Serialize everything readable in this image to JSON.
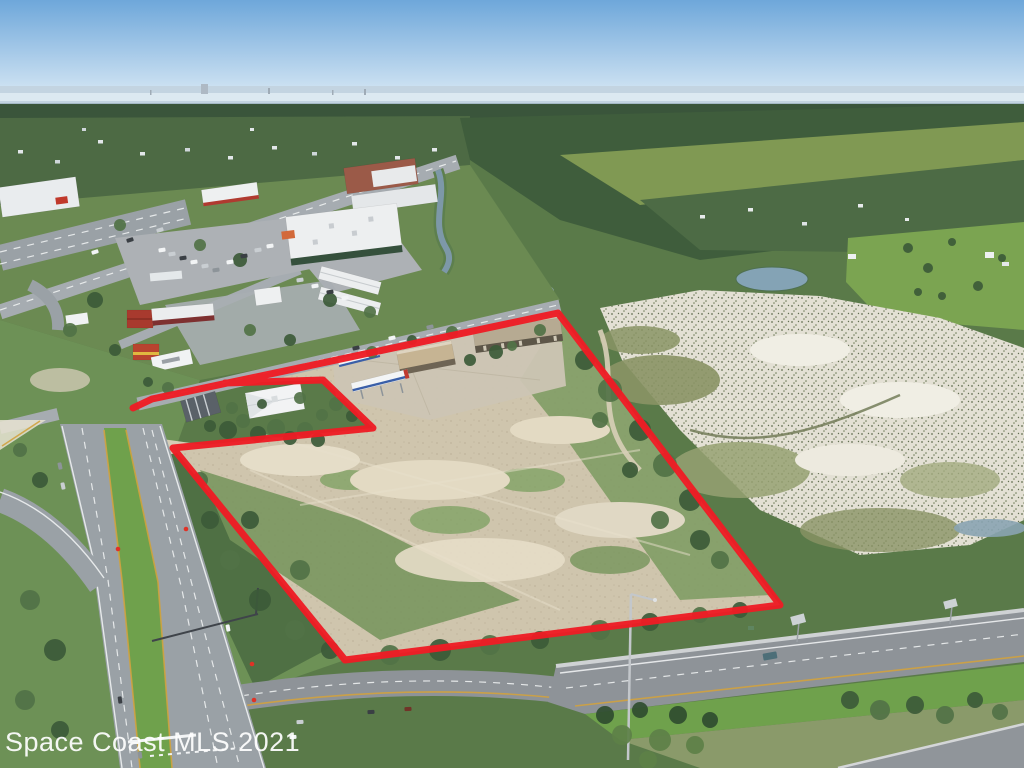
{
  "watermark": {
    "text": "Space Coast MLS 2021",
    "color": "#ffffff"
  },
  "boundary": {
    "color": "#ee1c24",
    "stroke_width": 7,
    "points": "133,408 152,399 558,313 780,605 345,660 173,448 373,428 323,380 225,383"
  },
  "palette": {
    "sky_top": "#6ea7da",
    "sky_horizon": "#d9e9f5",
    "water": "#c3d4e1",
    "water_streak": "#e2edf5",
    "far_shore": "#8ba3b0",
    "far_forest": "#3a553b",
    "suburb_green": "#4d6a44",
    "forest_right": "#3f5d3c",
    "marsh_grass_band": "#87a055",
    "mid_green_right": "#4d6b45",
    "golf_green": "#7ba451",
    "pond_blue": "#84a3b5",
    "land_base": "#5a7a49",
    "lawn_green": "#6b8a52",
    "bottomleft_grass": "#6d9156",
    "marsh_sand": "#e3e0d4",
    "marsh_olive": "#8a9465",
    "property_dirt": "#cfc5ad",
    "sand_light": "#e5ddc8",
    "concrete_pad": "#ccc5b4",
    "scrub_green": "#7b9a60",
    "shrub_dark": "#4f7044",
    "road_grey": "#a6acb1",
    "highway_grey": "#8e9398",
    "corridor_grey": "#9aa1a6",
    "parking_grey": "#adb1b5",
    "median_green": "#6fa14c",
    "signal_red": "#e03226"
  },
  "scene": {
    "houses": [
      [
        18,
        150,
        5,
        3.5,
        "#e3e7ea"
      ],
      [
        55,
        160,
        5,
        3.5,
        "#cfd6da"
      ],
      [
        98,
        140,
        5,
        3.5,
        "#e3e7ea"
      ],
      [
        140,
        152,
        5,
        3.5,
        "#e3e7ea"
      ],
      [
        185,
        148,
        5,
        3.5,
        "#cfd6da"
      ],
      [
        228,
        156,
        5,
        3.5,
        "#e3e7ea"
      ],
      [
        272,
        146,
        5,
        3.5,
        "#e3e7ea"
      ],
      [
        312,
        152,
        5,
        3.5,
        "#cfd6da"
      ],
      [
        352,
        142,
        5,
        3.5,
        "#e3e7ea"
      ],
      [
        395,
        156,
        5,
        3.5,
        "#e3e7ea"
      ],
      [
        82,
        128,
        4,
        3,
        "#cfd6da"
      ],
      [
        250,
        128,
        4,
        3,
        "#e3e7ea"
      ],
      [
        432,
        148,
        5,
        3.5,
        "#e3e7ea"
      ],
      [
        700,
        215,
        5,
        3.5,
        "#e8ebec"
      ],
      [
        748,
        208,
        5,
        3.5,
        "#e8ebec"
      ],
      [
        802,
        222,
        5,
        3.5,
        "#dfe3e6"
      ],
      [
        858,
        204,
        5,
        3.5,
        "#e8ebec"
      ],
      [
        905,
        218,
        4,
        3,
        "#e8ebec"
      ],
      [
        848,
        254,
        8,
        5,
        "#eef0f1"
      ],
      [
        985,
        252,
        9,
        6,
        "#eef0f1"
      ],
      [
        1002,
        262,
        7,
        4,
        "#e4e8ea"
      ]
    ],
    "trees": [
      [
        228,
        430,
        9,
        "#3c5a38"
      ],
      [
        243,
        421,
        7,
        "#517247"
      ],
      [
        258,
        434,
        8,
        "#3c5a38"
      ],
      [
        276,
        428,
        9,
        "#517247"
      ],
      [
        290,
        438,
        7,
        "#3c5a38"
      ],
      [
        305,
        430,
        8,
        "#517247"
      ],
      [
        318,
        440,
        7,
        "#3c5a38"
      ],
      [
        322,
        415,
        6,
        "#517247"
      ],
      [
        232,
        408,
        6,
        "#517247"
      ],
      [
        210,
        426,
        6,
        "#3c5a38"
      ],
      [
        336,
        404,
        7,
        "#517247"
      ],
      [
        352,
        416,
        6,
        "#3c5a38"
      ],
      [
        300,
        398,
        6,
        "#517247"
      ],
      [
        262,
        404,
        5,
        "#3c5a38"
      ],
      [
        168,
        388,
        6,
        "#517247"
      ],
      [
        148,
        382,
        5,
        "#3c5a38"
      ],
      [
        372,
        352,
        6,
        "#517247"
      ],
      [
        412,
        340,
        5,
        "#3c5a38"
      ],
      [
        452,
        332,
        6,
        "#517247"
      ],
      [
        496,
        352,
        7,
        "#3c5a38"
      ],
      [
        512,
        346,
        5,
        "#517247"
      ],
      [
        470,
        360,
        6,
        "#3c5a38"
      ],
      [
        540,
        330,
        6,
        "#517247"
      ],
      [
        585,
        360,
        10,
        "#3c5a38"
      ],
      [
        610,
        390,
        12,
        "#517247"
      ],
      [
        640,
        430,
        11,
        "#3c5a38"
      ],
      [
        665,
        465,
        12,
        "#517247"
      ],
      [
        690,
        500,
        11,
        "#3c5a38"
      ],
      [
        660,
        520,
        9,
        "#517247"
      ],
      [
        630,
        470,
        8,
        "#3c5a38"
      ],
      [
        600,
        420,
        8,
        "#517247"
      ],
      [
        700,
        540,
        10,
        "#3c5a38"
      ],
      [
        720,
        560,
        9,
        "#517247"
      ],
      [
        210,
        520,
        9,
        "#3c5a38"
      ],
      [
        230,
        560,
        10,
        "#517247"
      ],
      [
        260,
        600,
        11,
        "#3c5a38"
      ],
      [
        295,
        630,
        10,
        "#517247"
      ],
      [
        330,
        650,
        9,
        "#3c5a38"
      ],
      [
        390,
        655,
        10,
        "#517247"
      ],
      [
        440,
        650,
        11,
        "#3c5a38"
      ],
      [
        490,
        645,
        10,
        "#517247"
      ],
      [
        540,
        640,
        9,
        "#3c5a38"
      ],
      [
        600,
        630,
        10,
        "#517247"
      ],
      [
        650,
        622,
        9,
        "#3c5a38"
      ],
      [
        700,
        615,
        8,
        "#517247"
      ],
      [
        740,
        610,
        8,
        "#3c5a38"
      ],
      [
        605,
        715,
        9,
        "#2f4c2f"
      ],
      [
        622,
        735,
        10,
        "#5d8048"
      ],
      [
        640,
        710,
        8,
        "#2f4c2f"
      ],
      [
        660,
        740,
        11,
        "#5d8048"
      ],
      [
        678,
        715,
        9,
        "#2f4c2f"
      ],
      [
        695,
        745,
        9,
        "#5d8048"
      ],
      [
        710,
        720,
        8,
        "#2f4c2f"
      ],
      [
        648,
        760,
        9,
        "#5d8048"
      ],
      [
        850,
        700,
        9,
        "#3c5a38"
      ],
      [
        880,
        710,
        10,
        "#517247"
      ],
      [
        915,
        705,
        9,
        "#3c5a38"
      ],
      [
        945,
        715,
        9,
        "#517247"
      ],
      [
        975,
        700,
        8,
        "#3c5a38"
      ],
      [
        1000,
        712,
        8,
        "#517247"
      ],
      [
        908,
        248,
        5,
        "#3c5a38"
      ],
      [
        928,
        268,
        5,
        "#3c5a38"
      ],
      [
        952,
        242,
        4,
        "#3c5a38"
      ],
      [
        978,
        286,
        5,
        "#3c5a38"
      ],
      [
        1002,
        258,
        4,
        "#3c5a38"
      ],
      [
        942,
        296,
        4,
        "#3c5a38"
      ],
      [
        918,
        292,
        4,
        "#3c5a38"
      ],
      [
        120,
        225,
        6,
        "#517247"
      ],
      [
        240,
        260,
        7,
        "#3c5a38"
      ],
      [
        200,
        245,
        6,
        "#517247"
      ],
      [
        330,
        300,
        7,
        "#3c5a38"
      ],
      [
        370,
        312,
        6,
        "#517247"
      ],
      [
        95,
        300,
        8,
        "#3c5a38"
      ],
      [
        70,
        330,
        7,
        "#517247"
      ],
      [
        115,
        350,
        6,
        "#3c5a38"
      ],
      [
        250,
        330,
        6,
        "#517247"
      ],
      [
        290,
        340,
        6,
        "#3c5a38"
      ],
      [
        30,
        600,
        10,
        "#517247"
      ],
      [
        55,
        650,
        11,
        "#3c5a38"
      ],
      [
        25,
        700,
        10,
        "#517247"
      ],
      [
        60,
        730,
        9,
        "#3c5a38"
      ],
      [
        40,
        480,
        8,
        "#3c5a38"
      ],
      [
        20,
        450,
        7,
        "#517247"
      ],
      [
        200,
        480,
        8,
        "#4f7044"
      ],
      [
        250,
        520,
        9,
        "#3c5a38"
      ],
      [
        300,
        570,
        10,
        "#517247"
      ]
    ],
    "cars": [
      [
        162,
        250,
        "#f2f4f5",
        -8
      ],
      [
        172,
        254,
        "#c9ced2",
        -8
      ],
      [
        183,
        258,
        "#3a3f44",
        -8
      ],
      [
        194,
        262,
        "#f2f4f5",
        -8
      ],
      [
        205,
        266,
        "#c9ced2",
        -8
      ],
      [
        216,
        270,
        "#8d9499",
        -8
      ],
      [
        230,
        262,
        "#f2f4f5",
        -8
      ],
      [
        244,
        256,
        "#3a3f44",
        -8
      ],
      [
        258,
        250,
        "#c9ced2",
        -8
      ],
      [
        270,
        246,
        "#f2f4f5",
        -8
      ],
      [
        300,
        280,
        "#c9ced2",
        -8
      ],
      [
        315,
        286,
        "#f2f4f5",
        -8
      ],
      [
        330,
        292,
        "#3a3f44",
        -8
      ],
      [
        345,
        298,
        "#f2f4f5",
        -8
      ],
      [
        95,
        252,
        "#f2f4f5",
        -18
      ],
      [
        130,
        240,
        "#3a3f44",
        -18
      ],
      [
        160,
        230,
        "#c9ced2",
        -18
      ],
      [
        60,
        466,
        "#8d9499",
        78
      ],
      [
        63,
        486,
        "#c9ced2",
        78
      ],
      [
        228,
        628,
        "#f2f4f5",
        80
      ],
      [
        120,
        700,
        "#3a3f44",
        82
      ],
      [
        140,
        755,
        "#8d9499",
        82
      ],
      [
        392,
        338,
        "#f2f4f5",
        -13
      ],
      [
        430,
        327,
        "#8d9499",
        -13
      ],
      [
        356,
        348,
        "#3a3f44",
        -13
      ],
      [
        300,
        722,
        "#c9ced2",
        -4
      ],
      [
        371,
        712,
        "#3a3f44",
        -4
      ],
      [
        408,
        709,
        "#703428",
        -4
      ],
      [
        293,
        737,
        "#f2f4f5",
        -4
      ],
      [
        770,
        656,
        "#4d6e78",
        -10,
        1
      ]
    ]
  }
}
